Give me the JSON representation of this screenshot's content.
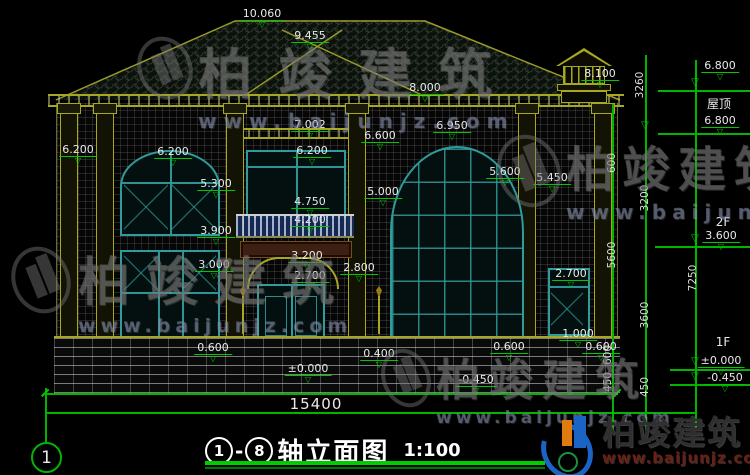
{
  "drawing": {
    "title": {
      "axis_start": "1",
      "dash": "-",
      "axis_end": "8",
      "name": "轴立面图",
      "scale": "1:100"
    },
    "axis_bubble_label": "1",
    "colors": {
      "dim_green": "#00c800",
      "cad_yellow": "#a8a820",
      "window_teal": "#2f9b9b",
      "text": "#e9e9e9"
    },
    "annotations": [
      {
        "text": "10.060",
        "kind": "level",
        "x": 262,
        "y": 8
      },
      {
        "text": "9.455",
        "kind": "level",
        "x": 310,
        "y": 30
      },
      {
        "text": "8.000",
        "kind": "level",
        "x": 425,
        "y": 82
      },
      {
        "text": "8.100",
        "kind": "level",
        "x": 600,
        "y": 68
      },
      {
        "text": "7.002",
        "kind": "level",
        "x": 310,
        "y": 119
      },
      {
        "text": "6.950",
        "kind": "level",
        "x": 452,
        "y": 120
      },
      {
        "text": "6.600",
        "kind": "level",
        "x": 380,
        "y": 130
      },
      {
        "text": "6.200",
        "kind": "level",
        "x": 312,
        "y": 145
      },
      {
        "text": "6.200",
        "kind": "level",
        "x": 173,
        "y": 146
      },
      {
        "text": "6.200",
        "kind": "level",
        "x": 78,
        "y": 144
      },
      {
        "text": "5.600",
        "kind": "level",
        "x": 505,
        "y": 166
      },
      {
        "text": "5.450",
        "kind": "level",
        "x": 552,
        "y": 172
      },
      {
        "text": "5.300",
        "kind": "level",
        "x": 216,
        "y": 178
      },
      {
        "text": "5.000",
        "kind": "level",
        "x": 383,
        "y": 186
      },
      {
        "text": "4.750",
        "kind": "level",
        "x": 310,
        "y": 196
      },
      {
        "text": "4.200",
        "kind": "level",
        "x": 310,
        "y": 214
      },
      {
        "text": "3.900",
        "kind": "level",
        "x": 216,
        "y": 225
      },
      {
        "text": "3.200",
        "kind": "level",
        "x": 307,
        "y": 250
      },
      {
        "text": "3.000",
        "kind": "level",
        "x": 214,
        "y": 259
      },
      {
        "text": "2.800",
        "kind": "level",
        "x": 359,
        "y": 262
      },
      {
        "text": "2.700",
        "kind": "level",
        "x": 310,
        "y": 270
      },
      {
        "text": "2.700",
        "kind": "level",
        "x": 571,
        "y": 268
      },
      {
        "text": "1.000",
        "kind": "level",
        "x": 578,
        "y": 328
      },
      {
        "text": "0.600",
        "kind": "level",
        "x": 213,
        "y": 342
      },
      {
        "text": "0.600",
        "kind": "level",
        "x": 509,
        "y": 341
      },
      {
        "text": "0.600",
        "kind": "level",
        "x": 601,
        "y": 341
      },
      {
        "text": "0.400",
        "kind": "level",
        "x": 379,
        "y": 348
      },
      {
        "text": "±0.000",
        "kind": "level",
        "x": 308,
        "y": 363
      },
      {
        "text": "-0.450",
        "kind": "level",
        "x": 476,
        "y": 374
      },
      {
        "text": "6.800",
        "kind": "level",
        "x": 720,
        "y": 60
      },
      {
        "text": "6.800",
        "kind": "level",
        "x": 720,
        "y": 115
      },
      {
        "text": "3.600",
        "kind": "level",
        "x": 721,
        "y": 230
      },
      {
        "text": "±0.000",
        "kind": "level",
        "x": 721,
        "y": 355
      },
      {
        "text": "-0.450",
        "kind": "level",
        "x": 725,
        "y": 372
      },
      {
        "text": "屋顶",
        "kind": "plain",
        "x": 719,
        "y": 98
      },
      {
        "text": "2F",
        "kind": "plain",
        "x": 723,
        "y": 216
      },
      {
        "text": "1F",
        "kind": "plain",
        "x": 723,
        "y": 336
      },
      {
        "text": "15400",
        "kind": "total",
        "x": 316,
        "y": 396
      },
      {
        "text": "3260",
        "kind": "v",
        "x": 641,
        "y": 85
      },
      {
        "text": "600",
        "kind": "v",
        "x": 613,
        "y": 163
      },
      {
        "text": "3200",
        "kind": "v",
        "x": 646,
        "y": 198
      },
      {
        "text": "5600",
        "kind": "v",
        "x": 613,
        "y": 255
      },
      {
        "text": "3600",
        "kind": "v",
        "x": 646,
        "y": 315
      },
      {
        "text": "7250",
        "kind": "v",
        "x": 694,
        "y": 278
      },
      {
        "text": "600",
        "kind": "v",
        "x": 609,
        "y": 355
      },
      {
        "text": "450",
        "kind": "v",
        "x": 609,
        "y": 382
      },
      {
        "text": "450",
        "kind": "v",
        "x": 646,
        "y": 387
      },
      {
        "text": "▽",
        "kind": "marker",
        "x": 645,
        "y": 120
      },
      {
        "text": "▽",
        "kind": "marker",
        "x": 695,
        "y": 77
      },
      {
        "text": "▽",
        "kind": "marker",
        "x": 695,
        "y": 233
      },
      {
        "text": "▽",
        "kind": "marker",
        "x": 695,
        "y": 356
      },
      {
        "text": "▽",
        "kind": "marker",
        "x": 695,
        "y": 371
      }
    ]
  },
  "watermark": {
    "brand": "柏竣建筑",
    "url": "www.baijunjz.com"
  },
  "logo": {
    "brand": "柏竣建筑",
    "url": "www.baijunjz.com"
  }
}
